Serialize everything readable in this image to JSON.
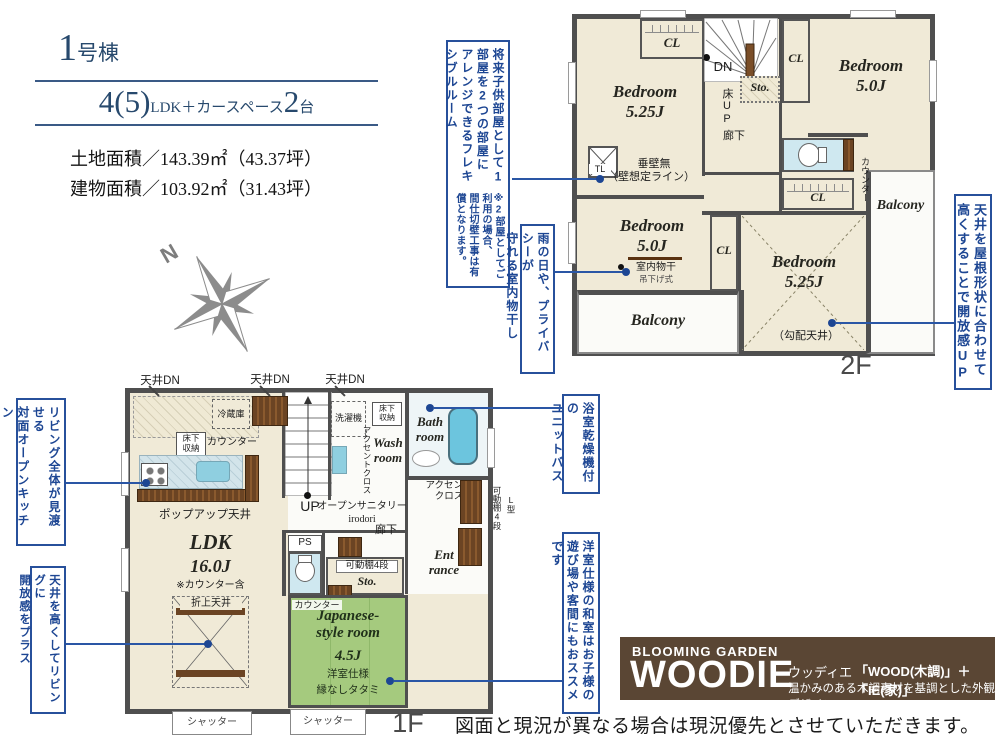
{
  "header": {
    "building_num": "1",
    "building_suffix": "号棟",
    "plan_part1": "4(5)",
    "plan_part2": "LDK＋カースペース",
    "plan_part3": "2",
    "plan_part4": "台",
    "land_label": "土地面積／143.39㎡（43.37坪）",
    "building_label": "建物面積／103.92㎡（31.43坪）"
  },
  "compass": {
    "n": "N"
  },
  "annotations": {
    "flexible_main": "将来子供部屋として1部屋を2つの部屋に\nアレンジできるフレキシブルルーム",
    "flexible_note": "※2部屋としてご利用の場合、\n間仕切壁工事は有償となります。",
    "indoor_drying": "雨の日や、プライバシーが\n守れる室内物干し",
    "roof_ceiling": "天井を屋根形状に合わせて\n高くすることで開放感UP",
    "unit_bath": "浴室乾燥機付の\nユニットバス",
    "tatami": "洋室仕様の和室はお子様の\n遊び場や客間にもおススメです",
    "open_kitchen": "リビング全体が見渡せる\n対面オープンキッチン\n（食洗器付き）",
    "living_ceiling": "天井を高くしてリビングに\n開放感をプラス"
  },
  "floor2": {
    "label": "2F",
    "bedroom_tl": "Bedroom\n5.25J",
    "bedroom_tr": "Bedroom\n5.0J",
    "bedroom_ml": "Bedroom\n5.0J",
    "bedroom_br": "Bedroom\n5.25J",
    "kobai": "（勾配天井）",
    "cl": "CL",
    "dn": "DN",
    "yuka_up": "床UP",
    "sto": "Sto.",
    "hall": "廊下",
    "counter": "カウンター",
    "tl": "TL",
    "tarekabe": "垂壁無",
    "kabe_line": "（壁想定ライン）",
    "monohoshi": "室内物干",
    "tsurisage": "吊下げ式",
    "balcony": "Balcony"
  },
  "floor1": {
    "label": "1F",
    "tenjo_dn": "天井DN",
    "fridge": "冷蔵庫",
    "counter": "カウンター",
    "yukashita": "床下\n収納",
    "popup": "ポップアップ天井",
    "ldk": "LDK",
    "ldk_size": "16.0J",
    "ldk_note": "※カウンター含",
    "oriage": "折上天井",
    "up": "UP",
    "washer": "洗濯機",
    "accent_v": "アクセントクロス",
    "accent2": "アクセント\nクロス",
    "wash_room": "Wash\nroom",
    "open_sanitary": "オープンサニタリー",
    "irodori": "irodori",
    "hall": "廊下",
    "ps": "PS",
    "shelf4": "可動棚4段",
    "l_type": "L型",
    "sto": "Sto.",
    "bath": "Bath\nroom",
    "entrance": "Ent\nrance",
    "jp_room": "Japanese-\nstyle room",
    "jp_size": "4.5J",
    "youshitsu": "洋室仕様",
    "tatami_edge": "縁なしタタミ",
    "shutter": "シャッター"
  },
  "brand": {
    "top": "BLOOMING GARDEN",
    "name": "WOODIE",
    "ruby": "ウッディエ",
    "formula": "「WOOD(木調)」＋「IE(家)」",
    "desc": "温かみのある木調素材を基調とした外観デザイン"
  },
  "disclaimer": "図面と現況が異なる場合は現況優先とさせていただきます。",
  "colors": {
    "accent_blue": "#1d4693",
    "wall": "#4f4f4f",
    "room_cream": "#f0ead7",
    "tatami_green": "#a5ca7e",
    "water_blue": "#cfe8f0",
    "tub_blue": "#6cc5de",
    "wood_brown": "#6b4423",
    "brand_brown": "#5a4634"
  }
}
